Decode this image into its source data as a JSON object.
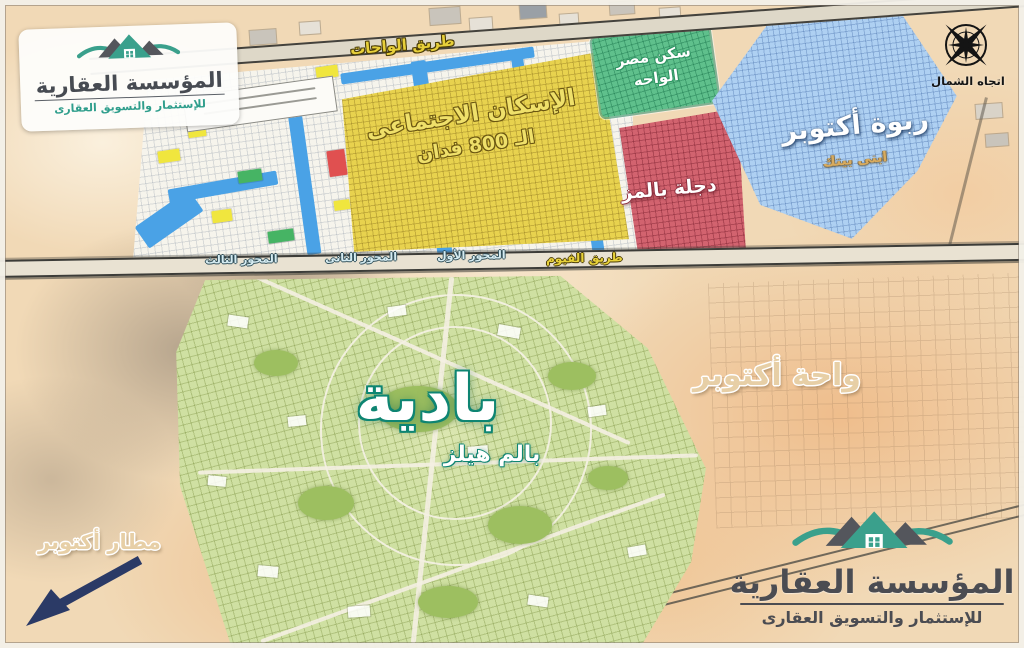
{
  "branding": {
    "top_logo": {
      "title": "المؤسسة العقارية",
      "subtitle": "للإستثمار والتسويق العقارى"
    },
    "bottom_logo": {
      "title": "المؤسسة العقارية",
      "subtitle": "للإستثمار والتسويق العقارى"
    }
  },
  "compass": {
    "label": "اتجاه الشمال"
  },
  "roads": {
    "wahat_road": "طريق الواحات",
    "fayoum_road": "طريق الفيوم",
    "axis_first": "المحور الأول",
    "axis_second": "المحور الثانى",
    "axis_third": "المحور الثالث"
  },
  "zones": {
    "social_housing": {
      "name_line1": "الإسكان الاجتماعى",
      "name_line2": "الـ 800 فدان",
      "color": "#e8d24e"
    },
    "sakan_misr": {
      "name_line1": "سكن مصر",
      "name_line2": "الواحه",
      "color": "#5fc08c"
    },
    "degla_palms": {
      "name": "دجلة بالمز",
      "color": "#d2636f"
    },
    "rabwa_october": {
      "name": "ربوة أكتوبر",
      "subtitle": "ابنى بيتك",
      "color": "#aed0f2"
    },
    "badya": {
      "name": "بادية",
      "developer": "بالم هيلز",
      "color": "#cfe0a2"
    }
  },
  "area_labels": {
    "october_oasis": "واحة أكتوبر",
    "october_airport": "مطار أكتوبر"
  }
}
